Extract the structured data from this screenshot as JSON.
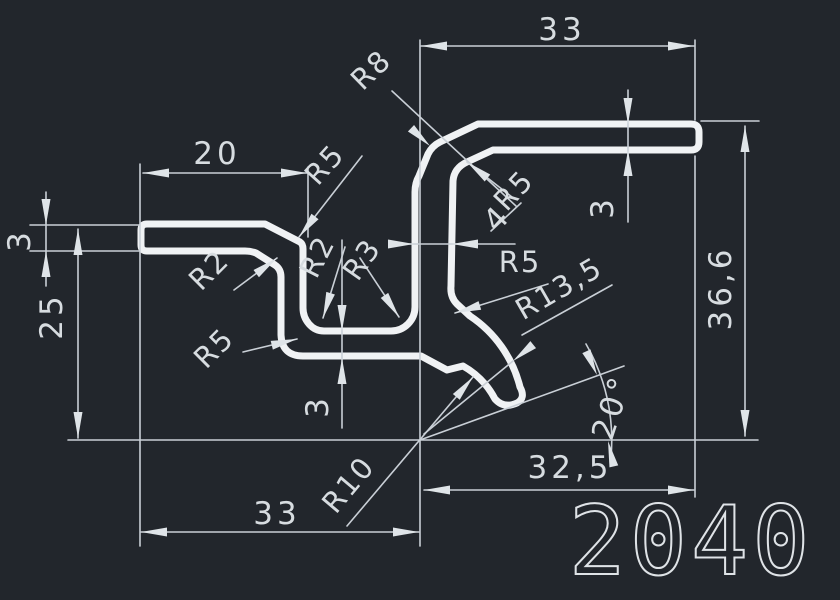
{
  "drawing": {
    "part_number": "2040",
    "type": "extrusion-profile-cross-section",
    "colors": {
      "background": "#22262c",
      "profile_line": "#f0f2f4",
      "dimension_line": "#c9cfd6",
      "text": "#d7dce0"
    },
    "labels": {
      "top_width": "33",
      "flange_width": "20",
      "left_thickness": "3",
      "left_height": "25",
      "bottom_width": "33",
      "bottom_right_width": "32,5",
      "overall_height": "36,6",
      "top_flange_thickness": "3",
      "web_thickness": "3",
      "stem_width": "4",
      "leg_angle": "20°",
      "r8": "R8",
      "r5_top_left": "R5",
      "r2_flange": "R2",
      "r5_outer": "R5",
      "r2_pocket": "R2",
      "r3_pocket": "R3",
      "r5_stem_top": "R5",
      "r5_stem_bottom": "R5",
      "r13_5": "R13,5",
      "r10": "R10",
      "part_number": "2040"
    }
  }
}
